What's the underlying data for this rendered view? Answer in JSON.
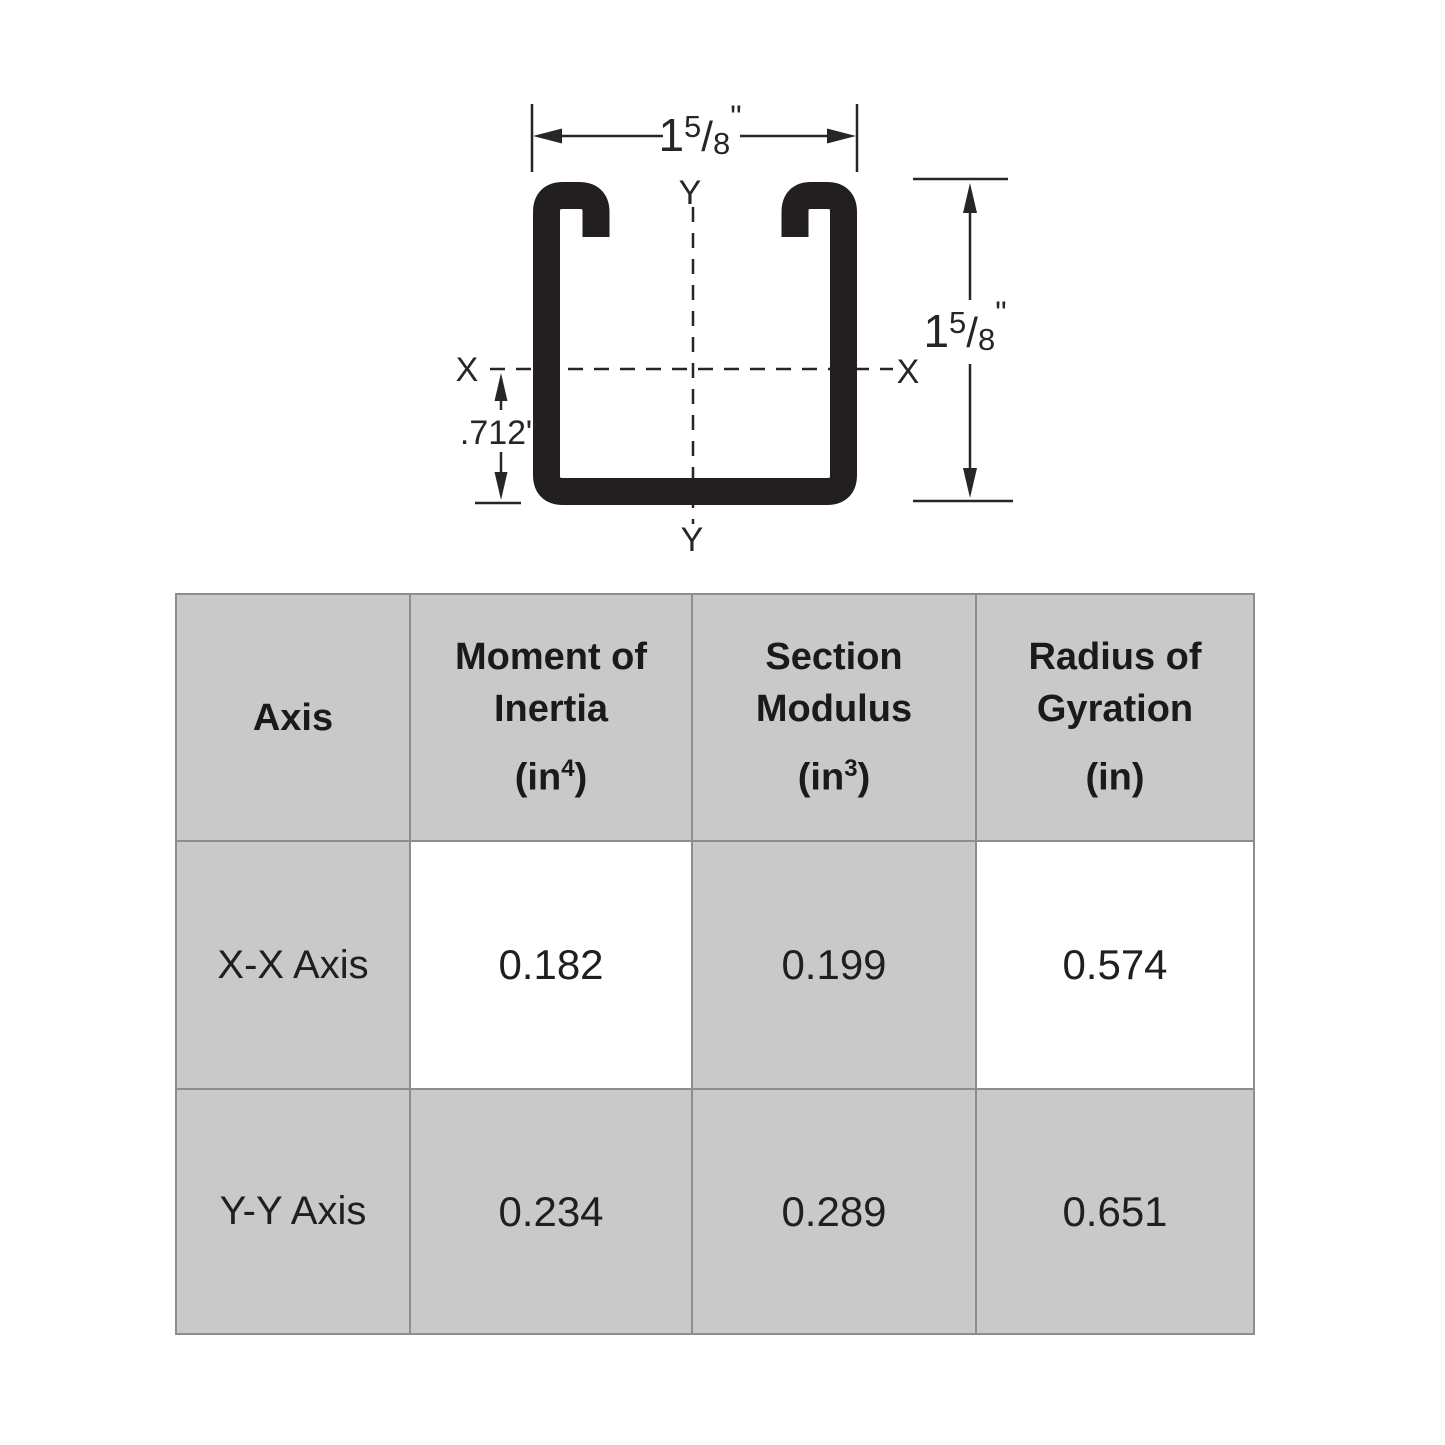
{
  "diagram": {
    "ink_color": "#262626",
    "labels": {
      "axis_x_left": "X",
      "axis_x_right": "X",
      "axis_y_top": "Y",
      "axis_y_bottom": "Y"
    },
    "dim_width": {
      "whole": "1",
      "numerator": "5",
      "slash": "/",
      "denominator": "8",
      "unit": "\""
    },
    "dim_height": {
      "whole": "1",
      "numerator": "5",
      "slash": "/",
      "denominator": "8",
      "unit": "\""
    },
    "dim_centroid": ".712\""
  },
  "table": {
    "grid_color": "#8d8d8d",
    "shade_color": "#c9c9c9",
    "columns": [
      {
        "label": "Axis",
        "unit_base": "",
        "unit_sup": "",
        "unit_close": ""
      },
      {
        "label": "Moment of Inertia",
        "unit_base": "(in",
        "unit_sup": "4",
        "unit_close": ")"
      },
      {
        "label": "Section Modulus",
        "unit_base": "(in",
        "unit_sup": "3",
        "unit_close": ")"
      },
      {
        "label": "Radius of Gyration",
        "unit_base": "(in",
        "unit_sup": "",
        "unit_close": ")"
      }
    ],
    "rows": [
      {
        "axis": "X-X Axis",
        "moment_of_inertia": "0.182",
        "section_modulus": "0.199",
        "radius_of_gyration": "0.574"
      },
      {
        "axis": "Y-Y Axis",
        "moment_of_inertia": "0.234",
        "section_modulus": "0.289",
        "radius_of_gyration": "0.651"
      }
    ]
  }
}
